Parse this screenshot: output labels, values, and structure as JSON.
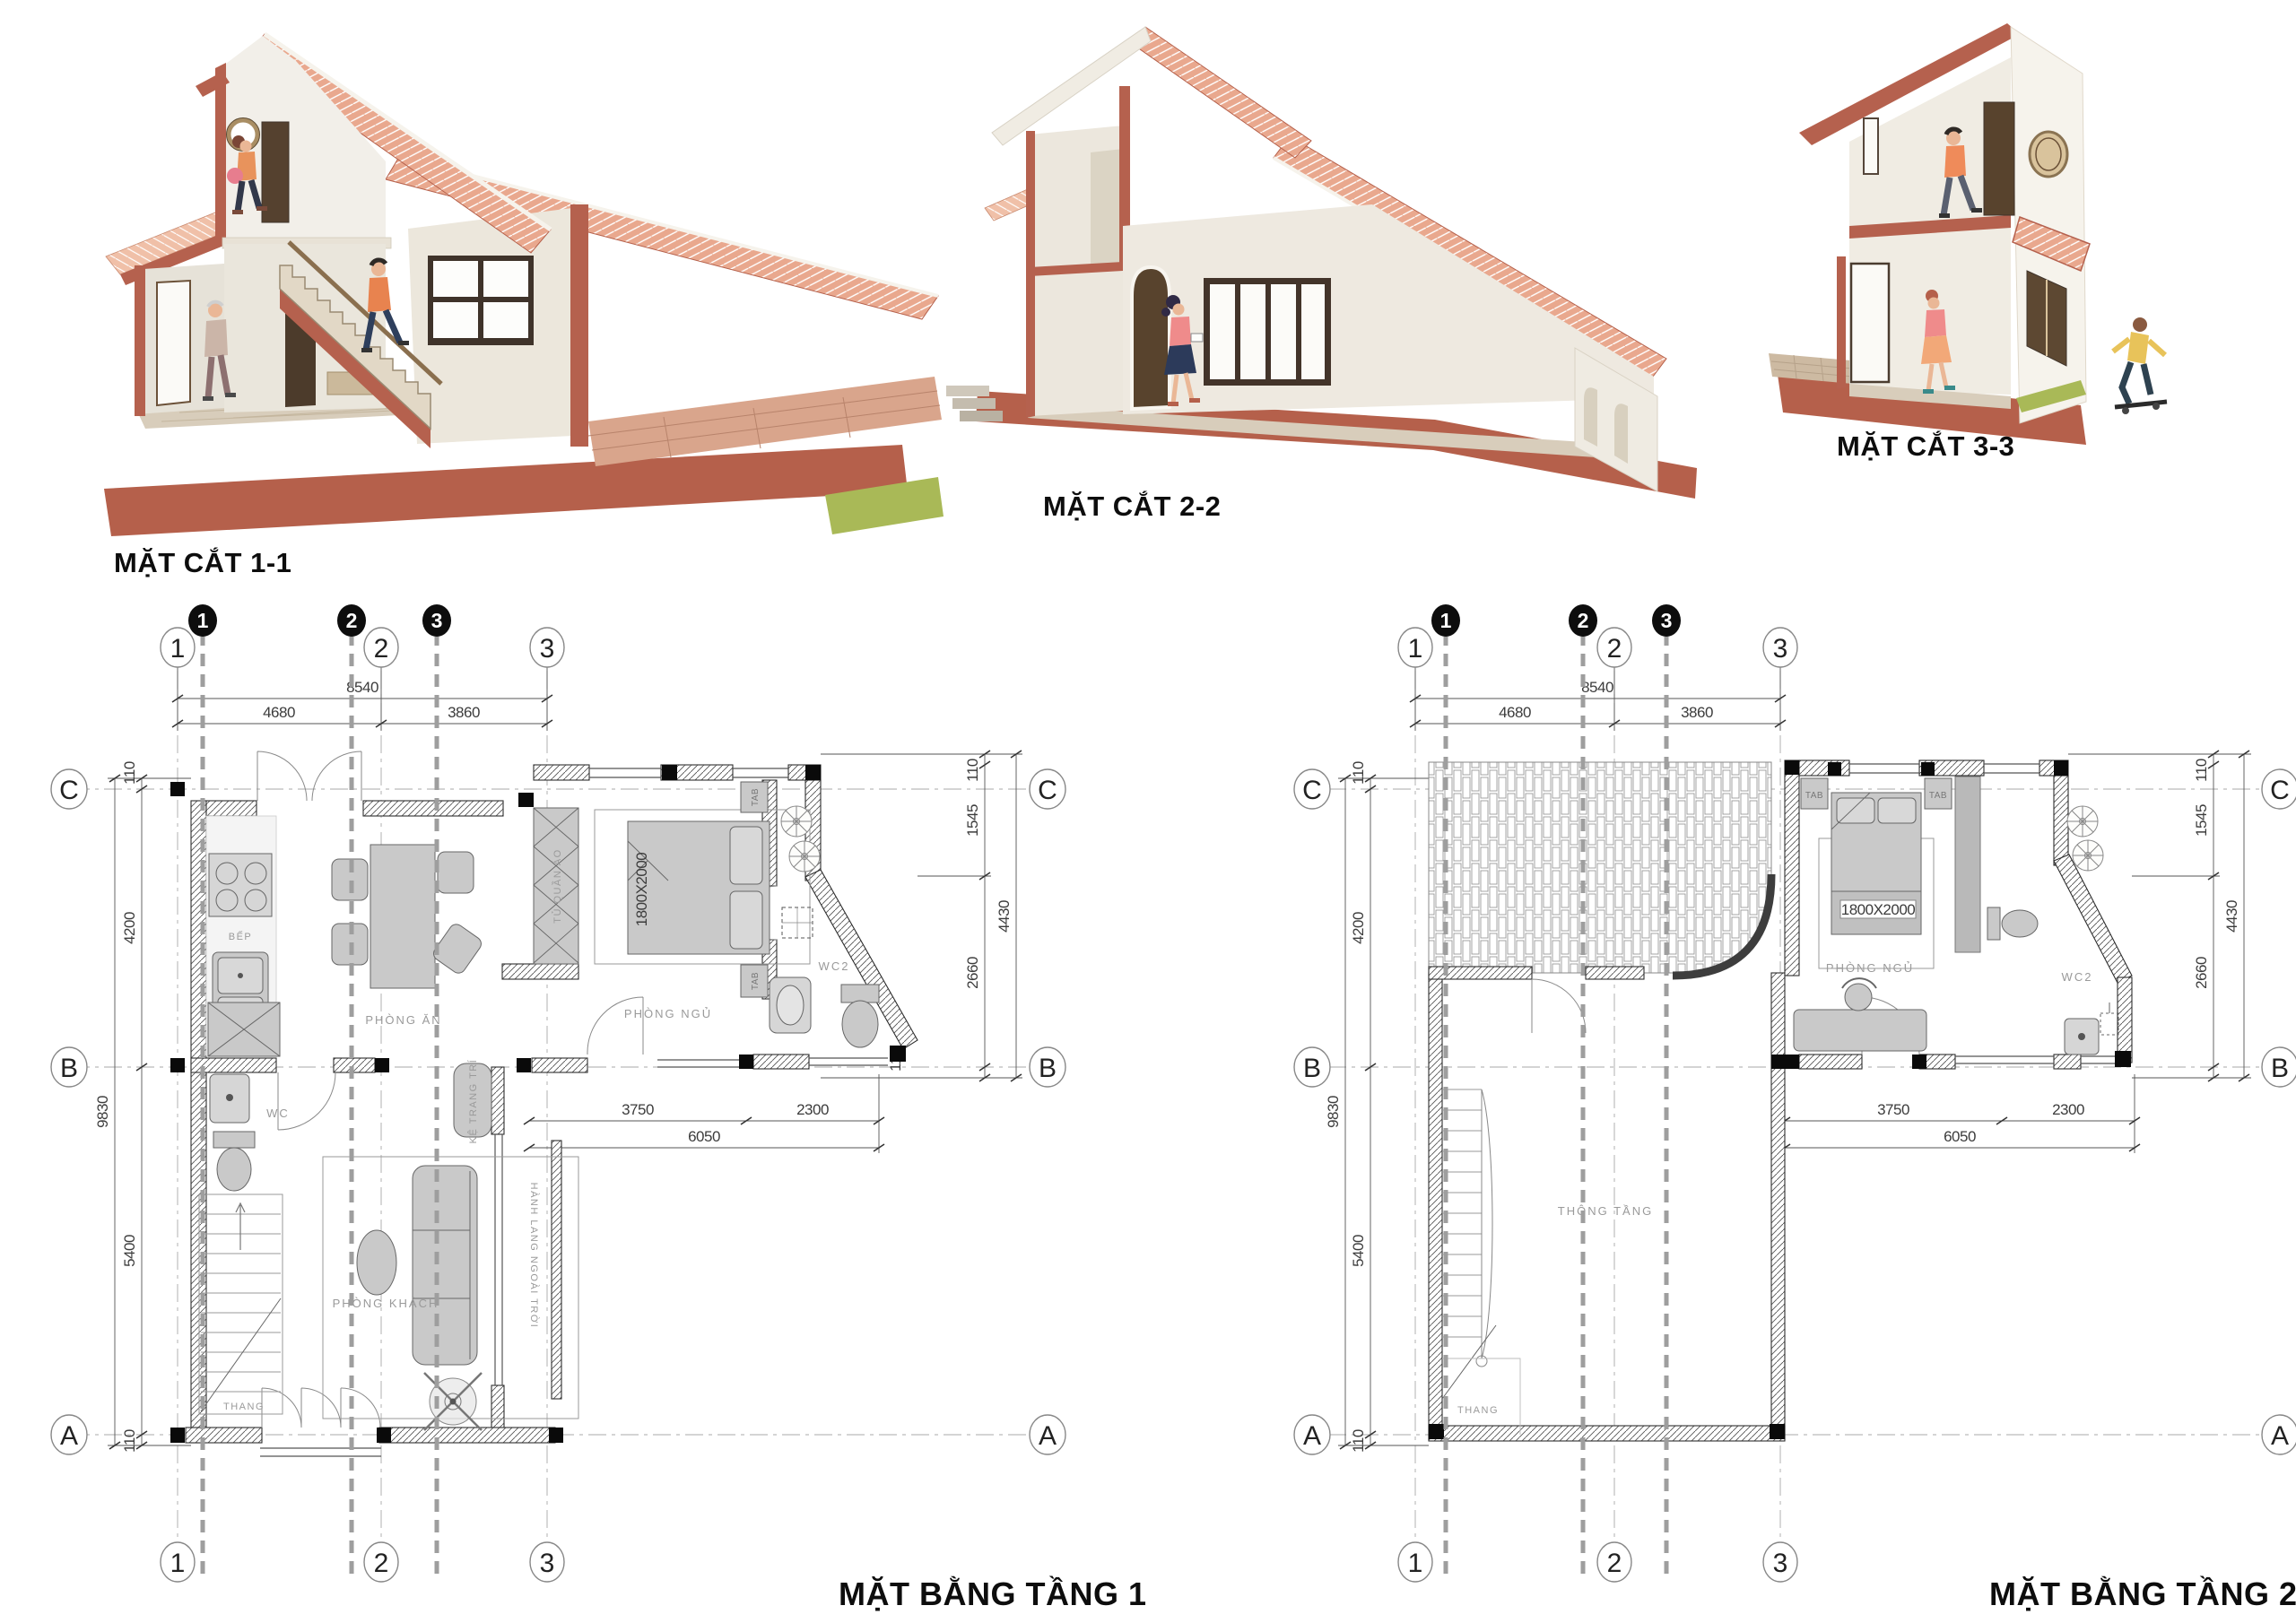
{
  "palette": {
    "terracotta": "#b5604b",
    "roof_tile": "#e9a88e",
    "wall_cream": "#efece4",
    "furniture_gray": "#c9c9c9",
    "line_dark": "#3a3a3a"
  },
  "sections": [
    {
      "label": "MẶT CẮT 1-1"
    },
    {
      "label": "MẶT CẮT 2-2"
    },
    {
      "label": "MẶT CẮT 3-3"
    }
  ],
  "plans": [
    {
      "title": "MẶT BẰNG TẦNG 1"
    },
    {
      "title": "MẶT BẰNG TẦNG 2"
    }
  ],
  "grid": {
    "c1": "1",
    "c2": "2",
    "c3": "3",
    "rA": "A",
    "rB": "B",
    "rC": "C"
  },
  "dims": {
    "w_total": "8540",
    "w1": "4680",
    "w2": "3860",
    "h_total": "9830",
    "h1": "4200",
    "h2": "5400",
    "edge": "110",
    "r1": "1545",
    "r_total": "4430",
    "r2": "2660",
    "b1": "3750",
    "b2": "2300",
    "b_total": "6050"
  },
  "rooms": {
    "kitchen": "BẾP",
    "dining": "PHÒNG ĂN",
    "wardrobe": "TỦ QUẦN ÁO",
    "bedroom": "PHÒNG NGỦ",
    "tab": "TAB",
    "bed_size": "1800X2000",
    "wc": "WC",
    "wc2": "WC2",
    "stairs": "THANG",
    "living": "PHÒNG KHÁCH",
    "shelf": "KỆ TRANG TRÍ",
    "corridor": "HÀNH LANG NGOÀI TRỜI",
    "void": "THÔNG TẦNG"
  }
}
